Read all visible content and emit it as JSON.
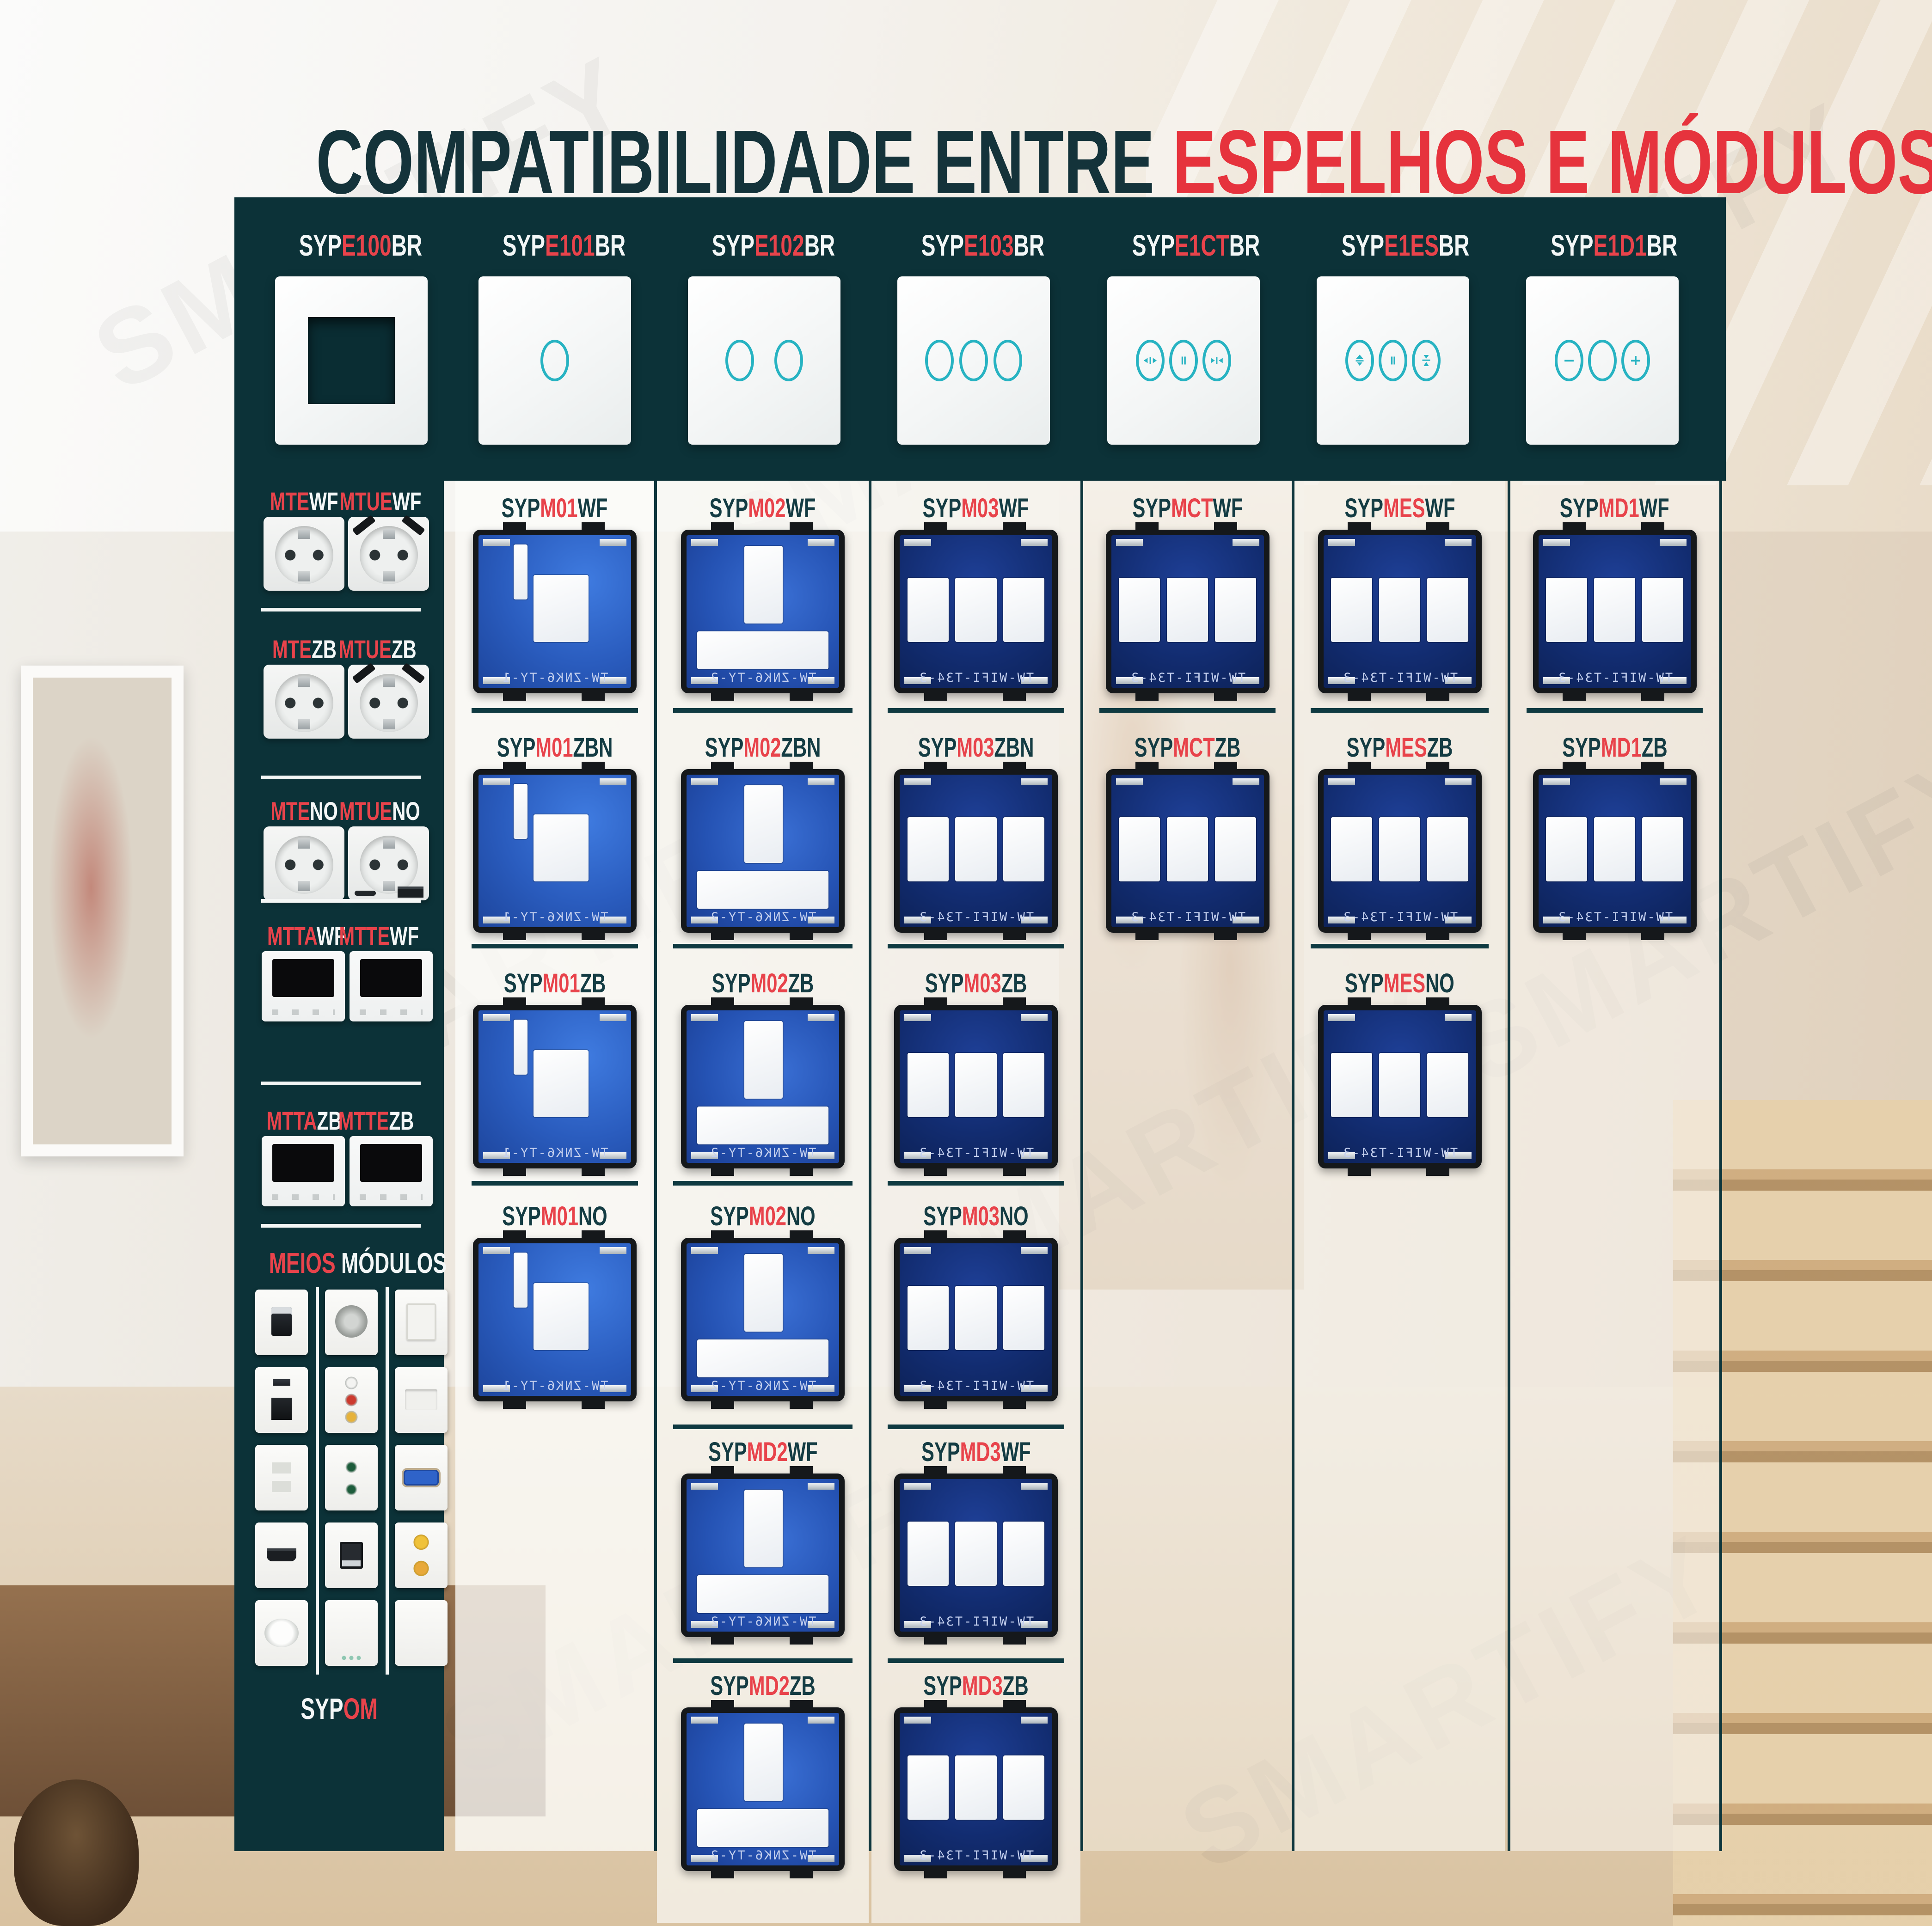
{
  "title": {
    "part1": "COMPATIBILIDADE ENTRE ",
    "part2": "ESPELHOS E MÓDULOS"
  },
  "colors": {
    "panel_teal": "#0c3238",
    "accent_red": "#e6333d",
    "label_red": "#e8434b",
    "label_dark": "#143c43",
    "label_white": "#f3f7f7",
    "touch_icon_teal": "#27b3c2"
  },
  "mirrors": [
    {
      "pre": "SYP",
      "mid": "E100",
      "suf": "BR",
      "icon": "empty-frame"
    },
    {
      "pre": "SYP",
      "mid": "E101",
      "suf": "BR",
      "icon": "touch-1-circle"
    },
    {
      "pre": "SYP",
      "mid": "E102",
      "suf": "BR",
      "icon": "touch-2-circles"
    },
    {
      "pre": "SYP",
      "mid": "E103",
      "suf": "BR",
      "icon": "touch-3-circles"
    },
    {
      "pre": "SYP",
      "mid": "E1CT",
      "suf": "BR",
      "icon": "curtain-open-pause-close"
    },
    {
      "pre": "SYP",
      "mid": "E1ES",
      "suf": "BR",
      "icon": "shutter-up-pause-down"
    },
    {
      "pre": "SYP",
      "mid": "E1D1",
      "suf": "BR",
      "icon": "dimmer-minus-circle-plus"
    }
  ],
  "sidebar": {
    "rows": [
      {
        "left": {
          "pre": "MTE",
          "suf": "WF"
        },
        "right": {
          "pre": "MTUE",
          "suf": "WF"
        },
        "left_img": "schuko-socket",
        "right_img": "schuko-socket-usb-top"
      },
      {
        "left": {
          "pre": "MTE",
          "suf": "ZB"
        },
        "right": {
          "pre": "MTUE",
          "suf": "ZB"
        },
        "left_img": "schuko-socket",
        "right_img": "schuko-socket-usb-top"
      },
      {
        "left": {
          "pre": "MTE",
          "suf": "NO"
        },
        "right": {
          "pre": "MTUE",
          "suf": "NO"
        },
        "left_img": "schuko-socket",
        "right_img": "schuko-socket-usb-bottom"
      },
      {
        "left": {
          "pre": "MTTA",
          "suf": "WF"
        },
        "right": {
          "pre": "MTTE",
          "suf": "WF"
        },
        "left_img": "thermostat",
        "right_img": "thermostat"
      },
      {
        "left": {
          "pre": "MTTA",
          "suf": "ZB"
        },
        "right": {
          "pre": "MTTE",
          "suf": "ZB"
        },
        "left_img": "thermostat",
        "right_img": "thermostat"
      }
    ],
    "meios": {
      "red": "MEIOS",
      "white": " MÓDULOS"
    },
    "sypom": {
      "pre": "SYP",
      "suf": "OM"
    },
    "half_modules": [
      "usb-a-module",
      "audio-connector-module",
      "blank-switch-module",
      "usb-c-usb-a-module",
      "rca-av-module",
      "blank-plate-module",
      "flat-socket-module",
      "audio-jacks-module",
      "vga-module",
      "hdmi-module",
      "usb-data-module",
      "sat-f-connectors-module",
      "dial-clock-module",
      "indicator-dots-module",
      "blank-module"
    ]
  },
  "columns": [
    {
      "mirror": "SYPE101BR",
      "cells": [
        {
          "pre": "SYP",
          "mid": "M01",
          "suf": "WF",
          "module": "m1"
        },
        {
          "pre": "SYP",
          "mid": "M01",
          "suf": "ZBN",
          "module": "m1"
        },
        {
          "pre": "SYP",
          "mid": "M01",
          "suf": "ZB",
          "module": "m1"
        },
        {
          "pre": "SYP",
          "mid": "M01",
          "suf": "NO",
          "module": "m1"
        }
      ]
    },
    {
      "mirror": "SYPE102BR",
      "cells": [
        {
          "pre": "SYP",
          "mid": "M02",
          "suf": "WF",
          "module": "m2"
        },
        {
          "pre": "SYP",
          "mid": "M02",
          "suf": "ZBN",
          "module": "m2"
        },
        {
          "pre": "SYP",
          "mid": "M02",
          "suf": "ZB",
          "module": "m2"
        },
        {
          "pre": "SYP",
          "mid": "M02",
          "suf": "NO",
          "module": "m2"
        },
        {
          "pre": "SYP",
          "mid": "MD2",
          "suf": "WF",
          "module": "m2"
        },
        {
          "pre": "SYP",
          "mid": "MD2",
          "suf": "ZB",
          "module": "m2"
        }
      ]
    },
    {
      "mirror": "SYPE103BR",
      "cells": [
        {
          "pre": "SYP",
          "mid": "M03",
          "suf": "WF",
          "module": "m3"
        },
        {
          "pre": "SYP",
          "mid": "M03",
          "suf": "ZBN",
          "module": "m3"
        },
        {
          "pre": "SYP",
          "mid": "M03",
          "suf": "ZB",
          "module": "m3"
        },
        {
          "pre": "SYP",
          "mid": "M03",
          "suf": "NO",
          "module": "m3"
        },
        {
          "pre": "SYP",
          "mid": "MD3",
          "suf": "WF",
          "module": "m3"
        },
        {
          "pre": "SYP",
          "mid": "MD3",
          "suf": "ZB",
          "module": "m3"
        }
      ]
    },
    {
      "mirror": "SYPE1CTBR",
      "cells": [
        {
          "pre": "SYP",
          "mid": "MCT",
          "suf": "WF",
          "module": "m3"
        },
        {
          "pre": "SYP",
          "mid": "MCT",
          "suf": "ZB",
          "module": "m3"
        }
      ]
    },
    {
      "mirror": "SYPE1ESBR",
      "cells": [
        {
          "pre": "SYP",
          "mid": "MES",
          "suf": "WF",
          "module": "m3"
        },
        {
          "pre": "SYP",
          "mid": "MES",
          "suf": "ZB",
          "module": "m3"
        },
        {
          "pre": "SYP",
          "mid": "MES",
          "suf": "NO",
          "module": "m3"
        }
      ]
    },
    {
      "mirror": "SYPE1D1BR",
      "cells": [
        {
          "pre": "SYP",
          "mid": "MD1",
          "suf": "WF",
          "module": "m3"
        },
        {
          "pre": "SYP",
          "mid": "MD1",
          "suf": "ZB",
          "module": "m3"
        }
      ]
    }
  ],
  "module_texts": {
    "m1": "TW-ZNK6-TY-1",
    "m2": "TW-ZNK6-TY-2",
    "m3": "TW-WIFI-T34-3"
  }
}
